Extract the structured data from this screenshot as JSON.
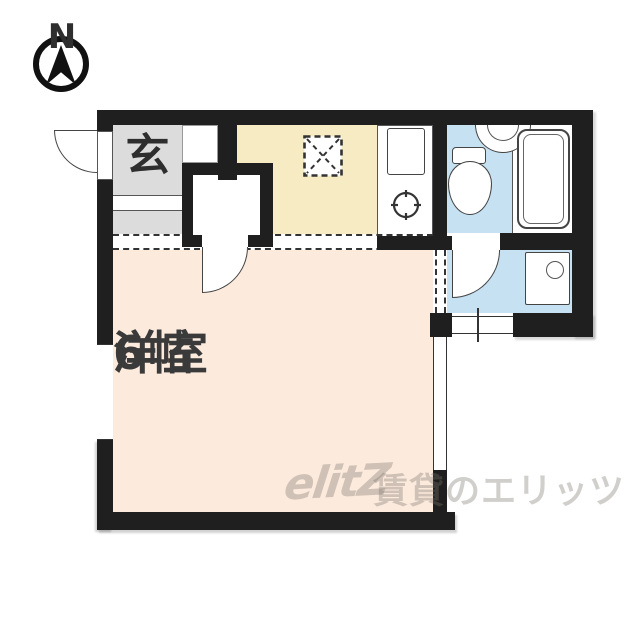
{
  "compass": {
    "north_label": "N"
  },
  "rooms": {
    "entrance": {
      "label": "玄"
    },
    "western_room": {
      "label": "洋室",
      "size_label": "6帖"
    }
  },
  "fixtures": [
    "entrance-door",
    "shoe-alcove",
    "closet",
    "closet-door",
    "refrigerator-space",
    "kitchen-sink",
    "stove-burner",
    "toilet",
    "washbasin",
    "bathtub",
    "bathroom-door",
    "washing-machine",
    "window-left",
    "window-right",
    "window-washroom"
  ],
  "watermark": {
    "logo_text": "elitZ",
    "service_text": "賃貸のエリッツ"
  },
  "colors": {
    "wall": "#1f1f1f",
    "entrance_floor": "#dcdcdc",
    "kitchen_floor": "#f7ebc3",
    "bathroom_floor": "#c6e1f2",
    "main_room_floor": "#fceadd",
    "label_text": "#3a3a3a",
    "watermark": "rgba(122,117,108,0.35)"
  }
}
